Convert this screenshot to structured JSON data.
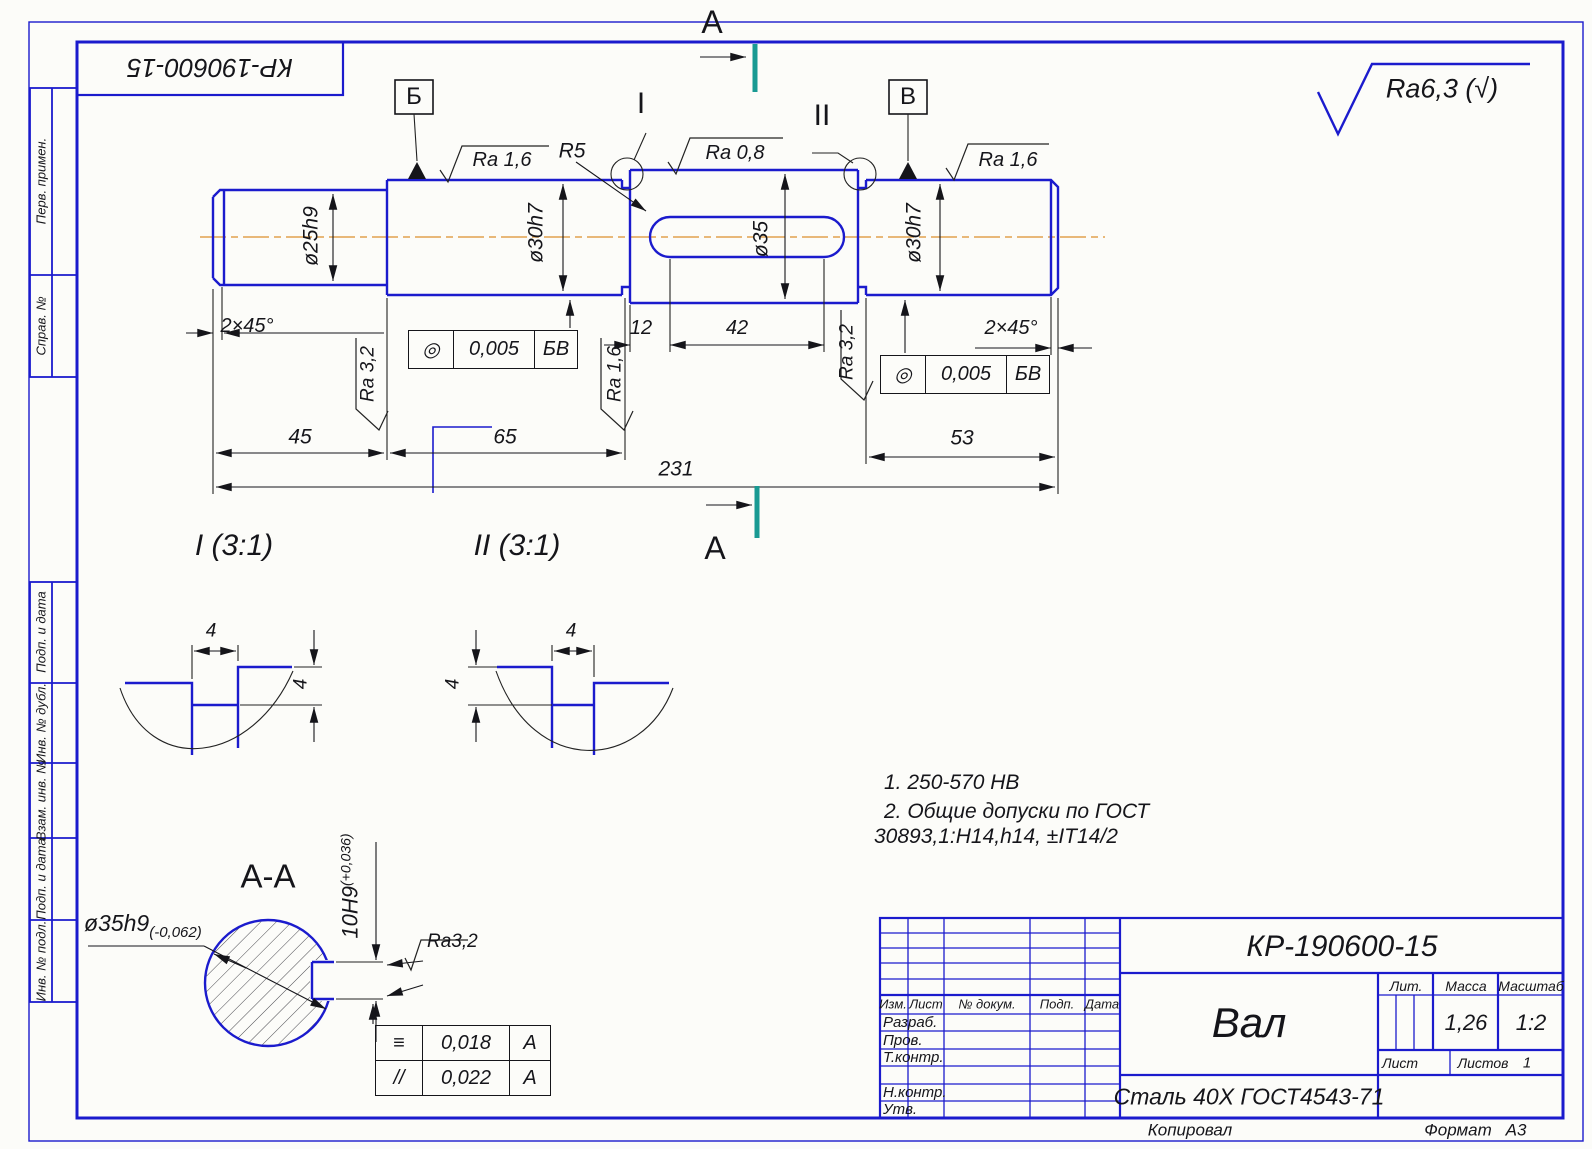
{
  "sheet": {
    "stamp_top_left": "КР-190600-15",
    "general_roughness": "Ra6,3 (√)",
    "footer": {
      "copied_label": "Копировал",
      "format_label": "Формат",
      "format_value": "А3"
    },
    "margin_labels": [
      "Перв. примен.",
      "Справ. №",
      "Подп. и дата",
      "Инв. № дубл.",
      "Взам. инв. №",
      "Подп. и дата",
      "Инв. № подл."
    ]
  },
  "main_view": {
    "section_letter_top": "А",
    "section_letter_bottom": "А",
    "datum_b": "Б",
    "datum_v": "В",
    "detail_marker_1": "I",
    "detail_marker_2": "II",
    "radius": "R5",
    "roughness": {
      "left": "Ra 1,6",
      "middle": "Ra 0,8",
      "right": "Ra 1,6",
      "shoulder_left": "Ra 3,2",
      "shoulder_middle": "Ra 1,6",
      "shoulder_right": "Ra 3,2"
    },
    "diameters": {
      "left_end": "ø25h9",
      "left_step": "ø30h7",
      "middle": "ø35",
      "right_step": "ø30h7"
    },
    "chamfers": {
      "left": "2×45°",
      "right": "2×45°"
    },
    "lengths": {
      "keyway_offset": "12",
      "keyway_length": "42",
      "left_end": "45",
      "left_step": "65",
      "right_step": "53",
      "overall": "231"
    },
    "tolerance_left": {
      "symbol": "◎",
      "value": "0,005",
      "datum": "БВ"
    },
    "tolerance_right": {
      "symbol": "◎",
      "value": "0,005",
      "datum": "БВ"
    }
  },
  "details": {
    "view1": {
      "title": "I (3:1)",
      "width": "4",
      "depth": "4"
    },
    "view2": {
      "title": "II (3:1)",
      "width": "4",
      "depth": "4"
    }
  },
  "notes": {
    "line1": "1. 250-570 НВ",
    "line2": "2. Общие допуски по ГОСТ",
    "line3": "30893,1:H14,h14, ±IT14/2"
  },
  "section_aa": {
    "title": "А-А",
    "diameter": "ø35h9",
    "diameter_tol": "(-0,062)",
    "keyway": "10H9",
    "keyway_tol": "(+0,036)",
    "roughness": "Ra3,2",
    "tol_symmetry": {
      "symbol": "≡",
      "value": "0,018",
      "datum": "А"
    },
    "tol_parallel": {
      "symbol": "//",
      "value": "0,022",
      "datum": "А"
    }
  },
  "title_block": {
    "doc_number": "КР-190600-15",
    "part_name": "Вал",
    "material": "Сталь 40Х ГОСТ4543-71",
    "col_izm": "Изм.",
    "col_list": "Лист",
    "col_doc": "№ докум.",
    "col_podp": "Подп.",
    "col_data": "Дата",
    "row_razrab": "Разраб.",
    "row_prov": "Пров.",
    "row_tkontr": "Т.контр.",
    "row_nkontr": "Н.контр.",
    "row_utv": "Утв.",
    "lit_label": "Лит.",
    "mass_label": "Масса",
    "scale_label": "Масштаб",
    "mass_value": "1,26",
    "scale_value": "1:2",
    "sheet_label": "Лист",
    "sheets_label": "Листов",
    "sheets_value": "1"
  }
}
